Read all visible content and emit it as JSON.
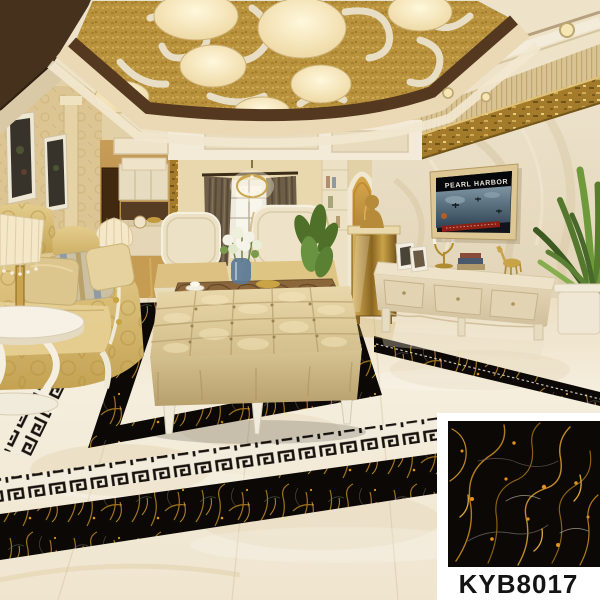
{
  "product": {
    "code": "KYB8017"
  },
  "tv": {
    "screen_title": "PEARL HARBOR"
  },
  "palette": {
    "swatch_background": "#ffffff",
    "label_text": "#141414",
    "black_gold_marble": "#0c0806",
    "gold_vein": "#c8871e",
    "floor_marble": "#f1e9d7",
    "greek_key_ivory": "#f2ecdc",
    "greek_key_black": "#17120d",
    "ceiling_gold": "#b8923c",
    "wood_frame": "#54381f",
    "sofa_gold": "#d6b96a",
    "wall_beige": "#dfcda4",
    "curtain_brown": "#6e5e46",
    "plant_green": "#567c2c"
  },
  "scene": {
    "setting": "luxury living room tile showcase",
    "elements": [
      "gold scroll ceiling with drum lights",
      "crystal chandelier",
      "gold damask sofa",
      "wingback armchairs",
      "tufted leather ottoman",
      "marble top coffee table",
      "marble tv wall",
      "wall mounted tv",
      "tv cabinet",
      "greek key floor border",
      "black gold marble floor inlay",
      "potted plants",
      "product swatch card"
    ]
  }
}
